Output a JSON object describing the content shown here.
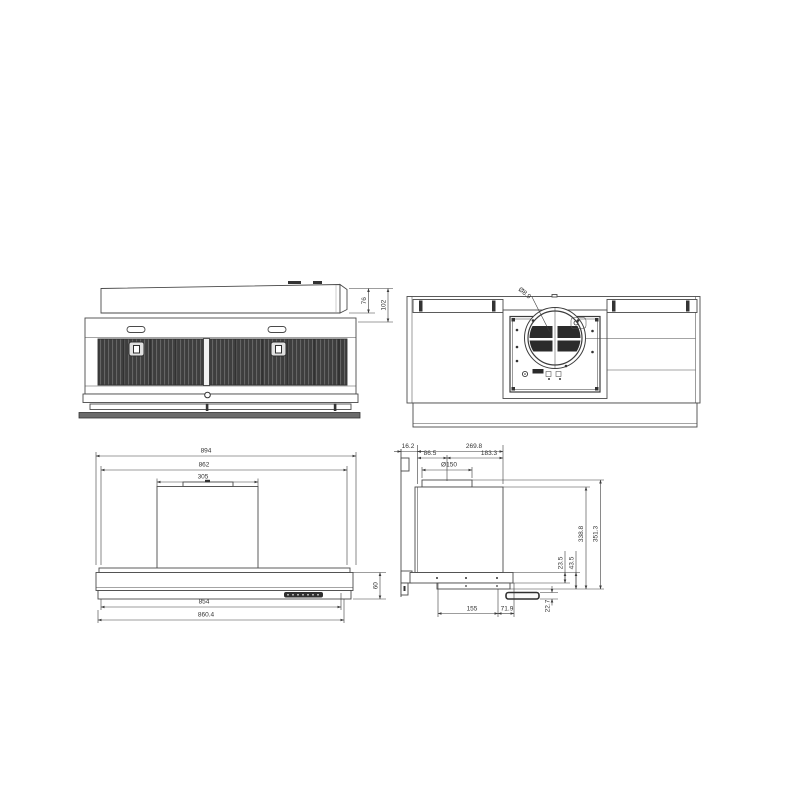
{
  "drawing": {
    "background": "#ffffff",
    "line_color": "#4a4a4a",
    "dim_color": "#3c3c3c",
    "filter_color": "#3e3e3e"
  },
  "front_view": {
    "dims": {
      "chimney_height": "76",
      "total_height": "102"
    }
  },
  "top_view": {
    "dims": {
      "hole_diameter": "Ø8.9"
    }
  },
  "rear_view": {
    "dims": {
      "width_overall": "894",
      "width_inner": "862",
      "duct_cover_width": "305",
      "body_height": "60",
      "width_lower": "854",
      "width_base": "860.4"
    }
  },
  "side_view": {
    "dims": {
      "back_offset": "16.2",
      "depth_overall": "269.8",
      "depth_to_duct_center": "86.5",
      "duct_center_to_front": "183.3",
      "duct_diameter": "Ø150",
      "height_body": "338.8",
      "height_overall": "351.3",
      "offset_small": "23.5",
      "offset_medium": "43.5",
      "visor_height": "22.7",
      "base_depth": "155",
      "base_front_offset": "71.9"
    }
  }
}
